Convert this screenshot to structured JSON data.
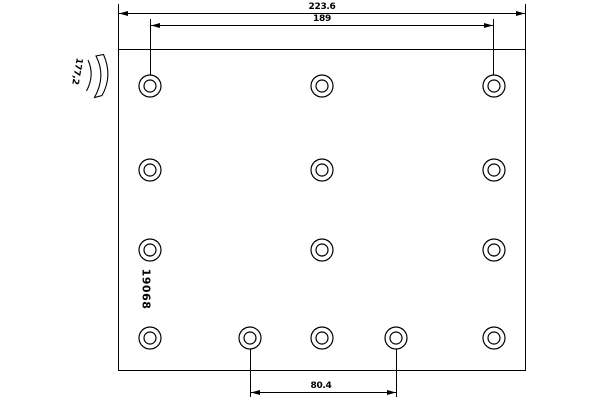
{
  "drawing": {
    "title": "brake-lining-technical-drawing",
    "part_number": "19068",
    "dimensions": {
      "total_width": "223.6",
      "hole_span_top": "189",
      "profile_height": "177,2",
      "hole_span_bottom": "80.4"
    },
    "plate": {
      "x": 118,
      "y": 49,
      "width": 408,
      "height": 322
    },
    "holes": {
      "outer_r": 11,
      "inner_r": 6,
      "centers": [
        [
          150,
          86
        ],
        [
          322,
          86
        ],
        [
          494,
          86
        ],
        [
          150,
          170
        ],
        [
          322,
          170
        ],
        [
          494,
          170
        ],
        [
          150,
          250
        ],
        [
          322,
          250
        ],
        [
          494,
          250
        ],
        [
          150,
          338
        ],
        [
          250,
          338
        ],
        [
          322,
          338
        ],
        [
          396,
          338
        ],
        [
          494,
          338
        ]
      ]
    }
  },
  "colors": {
    "line": "#000000",
    "background": "#ffffff"
  }
}
